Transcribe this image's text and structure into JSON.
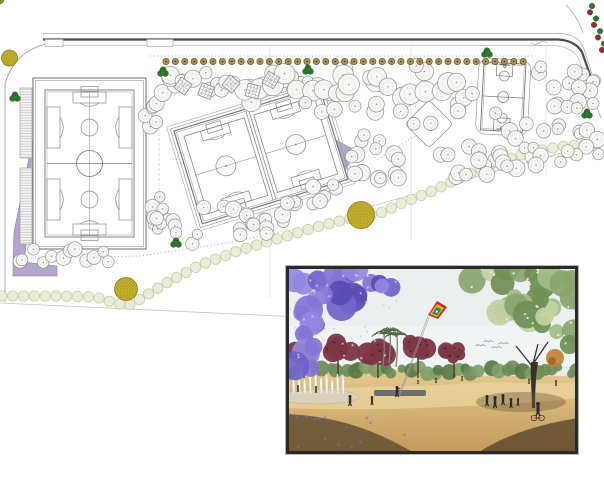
{
  "canvas": {
    "width": 604,
    "height": 480,
    "background": "#ffffff"
  },
  "palette": {
    "road_dark": "#4c4c4c",
    "road_light": "#aaaaaa",
    "sidewalk": "#c8c8c8",
    "guide": "#d9d9d9",
    "dotted": "#9a9a9a",
    "boundary": "#c4c4c4",
    "field_line": "#7a7a7a",
    "field_line_light": "#9a9a9a",
    "tree_white_fill": "#f7f7f4",
    "tree_white_stroke": "#8c8c8c",
    "tree_inner": "#b0b0b0",
    "tree_yellow": "#d2d63a",
    "tree_yellow_speck": "#8f961c",
    "tree_purple": "#8a7cc4",
    "tree_purple_speck": "#55449b",
    "tree_red": "#93312e",
    "tree_red_speck": "#5e1c1c",
    "tree_green_fleck": "#7da13c",
    "accent_green": "#2e7a2c",
    "accent_green_dark": "#1d5a1c",
    "street_tree_fill": "#b2975a",
    "street_tree_stroke": "#6b5b33",
    "street_tree_dot": "#4a3c1c",
    "scallop_fill": "#e9ecd6",
    "scallop_stroke": "#c2c9a4",
    "big_yellow_fill": "#c7b22b",
    "big_yellow_dot": "#9d8c1d",
    "big_yellow_stroke": "#8f7d16",
    "bed_purple": "#b3a5cc",
    "bed_purple_stroke": "#8f7fae",
    "pergola_stroke": "#8a8a8a",
    "photo_frame": "#2a2a2a",
    "photo_sky": "#eceff0",
    "photo_sand_top": "#e3c98e",
    "photo_sand_bottom": "#c2995a",
    "photo_sand_bright": "#ecd6a0",
    "photo_shadow": "#5d4b30",
    "photo_shadow2": "#523f27",
    "jacaranda": [
      "#6f63c8",
      "#8275d6",
      "#5a4bb2",
      "#9487e0"
    ],
    "green_tree": [
      "#8aa56e",
      "#a3bb85",
      "#c2d2a2",
      "#708f55"
    ],
    "distant_band": [
      "#6d8c58",
      "#7fa065",
      "#597947"
    ],
    "maroon_tree": "#7c3747",
    "maroon_speck": "#571f31",
    "palm_frond": "#50663c",
    "palm_trunk": "#8f8068",
    "kite_bands": [
      "#cc2b24",
      "#f2b81f",
      "#2e9c3f",
      "#1f66c4",
      "#f2f2f2"
    ],
    "string": "#9a9a9a",
    "person": "#2e2c2a",
    "water_jet": "#fdfdfd",
    "water_jet_edge": "#c8ced4",
    "basin": "#d8d2c2",
    "pool": "#3d4f63",
    "orange_tree": "#c08030",
    "bird": "#8a8a8a",
    "trunk": "#3a3228"
  },
  "plan": {
    "roads": {
      "north_top": "M43,33.5 L560,33.5 Q576,34 583,46 L597,90",
      "north_main": "M43,39.5 L558,39.5 Q575,40.5 582,52 L596,92",
      "north_inner": "M48,45.5 L554,45.5 Q570,46.5 578,57 L592,95",
      "corner_outer": "M566,5 Q578,17 583,33",
      "exit_line": "M592,95 L601,118",
      "west_arc": "M46,44 Q14,52 5,84 L5,302",
      "bays": [
        {
          "x": 45,
          "y": 39.5,
          "w": 18,
          "h": 7
        },
        {
          "x": 147,
          "y": 39.5,
          "w": 26,
          "h": 7
        }
      ],
      "wave": "M531,43 q4,3 8,0 q4,-3 8,0"
    },
    "guides": {
      "verticals": [
        {
          "x": 270,
          "y0": 46,
          "y1": 298
        },
        {
          "x": 411,
          "y0": 46,
          "y1": 240
        },
        {
          "x": 546,
          "y0": 46,
          "y1": 176
        }
      ],
      "dashed_vertical": {
        "x": 159,
        "y0": 88,
        "y1": 235
      },
      "boundary_line": "M0,303 L322,318",
      "path_edge": "M372,206 L604,141",
      "dotted_lines": [
        "M150,56 L535,56",
        "M35,258 L140,256 L220,244 L300,228 L380,210 L430,196",
        "M436,186 L570,152",
        "M402,94 L422,113",
        "M418,134 L377,160"
      ]
    },
    "scallops": {
      "polyline": [
        [
          2,
          296
        ],
        [
          60,
          296
        ],
        [
          96,
          297
        ],
        [
          112,
          302
        ],
        [
          128,
          306
        ],
        [
          142,
          298
        ],
        [
          168,
          282
        ],
        [
          200,
          265
        ],
        [
          240,
          250
        ],
        [
          280,
          238
        ],
        [
          320,
          226
        ],
        [
          352,
          218
        ],
        [
          378,
          214
        ],
        [
          400,
          204
        ],
        [
          430,
          192
        ],
        [
          462,
          177
        ],
        [
          495,
          163
        ],
        [
          530,
          152
        ],
        [
          565,
          146
        ],
        [
          602,
          143
        ]
      ],
      "spacing": 10.8,
      "radius": 5.2
    },
    "street_trees": {
      "y": 61.5,
      "x0": 166,
      "x1": 532,
      "step": 9.4,
      "radius": 3.1
    },
    "edge_trees": {
      "p0": [
        590,
        6
      ],
      "p1": [
        604,
        50
      ],
      "count": 8,
      "radius": 2.8
    },
    "big_yellow_circles": [
      [
        9.5,
        58,
        8
      ],
      [
        126,
        289,
        11.5
      ],
      [
        361,
        215,
        13.5
      ]
    ],
    "accent_trees": [
      [
        15,
        97
      ],
      [
        163,
        72
      ],
      [
        308,
        70
      ],
      [
        487,
        53
      ],
      [
        176,
        243
      ],
      [
        587,
        114
      ]
    ],
    "beds": {
      "west_wedge": "M39,108 L43,112 L24,262 L13,262 L14,232 Z",
      "corner_L": "M13,262 L24,262 L57,266 L57,276 L13,276 Z",
      "east_triangle": "M336,140 L356,151 L341,178 Z"
    },
    "left_field": {
      "outer": [
        33,
        78,
        113,
        171
      ],
      "outer2": [
        35.5,
        80.5,
        108,
        166
      ],
      "inner": [
        45,
        90,
        89,
        147
      ],
      "inner2": [
        47,
        92,
        85,
        143
      ],
      "mid_y": 163.5,
      "center": [
        89.5,
        163.5,
        13
      ],
      "sub_circles": [
        [
          89.5,
          127.5,
          8.5
        ],
        [
          89.5,
          199.5,
          8.5
        ]
      ],
      "bleachers": [
        [
          20,
          88,
          12,
          70
        ],
        [
          20,
          168,
          12,
          76
        ]
      ],
      "small_buildings": [
        [
          60,
          87,
          13,
          9
        ],
        [
          60,
          98,
          13,
          16
        ]
      ]
    },
    "rotated_block": {
      "x": 174,
      "y": 131,
      "angle": -17,
      "w": 152,
      "h": 97,
      "pitch_xs": [
        8,
        81
      ],
      "pitch_w": 63
    },
    "basketball": {
      "x": 484,
      "y": 62,
      "angle": 3,
      "w": 42,
      "h": 68
    },
    "diamond": {
      "cx": 429,
      "cy": 124,
      "half": 17
    },
    "pergolas": [
      [
        183,
        86,
        35
      ],
      [
        206,
        91,
        20
      ],
      [
        231,
        84,
        40
      ],
      [
        253,
        91,
        15
      ],
      [
        271,
        80,
        30
      ]
    ],
    "clusters": [
      {
        "name": "yellow-grove-west",
        "type": "yellow",
        "pts": [
          [
            150,
            126
          ],
          [
            153,
            104
          ],
          [
            162,
            90
          ],
          [
            176,
            82
          ],
          [
            192,
            88
          ],
          [
            207,
            80
          ]
        ],
        "count": 15,
        "jitter": 9,
        "rmin": 5.5,
        "rmax": 9,
        "seed": 11
      },
      {
        "name": "yellow-grove-north",
        "type": "yellow",
        "pts": [
          [
            215,
            88
          ],
          [
            235,
            78
          ],
          [
            255,
            90
          ],
          [
            277,
            79
          ],
          [
            298,
            90
          ],
          [
            318,
            82
          ],
          [
            332,
            94
          ]
        ],
        "count": 15,
        "jitter": 8,
        "rmin": 5.5,
        "rmax": 9,
        "mix": 0.35,
        "seed": 22
      },
      {
        "name": "white-grove-north",
        "type": "white",
        "pts": [
          [
            250,
            96
          ],
          [
            285,
            74
          ],
          [
            320,
            92
          ],
          [
            355,
            72
          ],
          [
            390,
            94
          ],
          [
            425,
            76
          ],
          [
            455,
            95
          ],
          [
            472,
            84
          ]
        ],
        "count": 30,
        "jitter": 13,
        "rmin": 7,
        "rmax": 11,
        "seed": 33
      },
      {
        "name": "white-grove-tail",
        "type": "white",
        "pts": [
          [
            300,
            108
          ],
          [
            340,
            112
          ],
          [
            380,
            104
          ],
          [
            420,
            118
          ],
          [
            450,
            112
          ]
        ],
        "count": 10,
        "jitter": 8,
        "rmin": 6,
        "rmax": 9,
        "seed": 44
      },
      {
        "name": "purple-grove-ne",
        "type": "purple",
        "pts": [
          [
            540,
            66
          ],
          [
            562,
            84
          ],
          [
            584,
            68
          ],
          [
            600,
            86
          ],
          [
            580,
            100
          ],
          [
            556,
            108
          ],
          [
            588,
            112
          ]
        ],
        "count": 16,
        "jitter": 9,
        "rmin": 5.5,
        "rmax": 8.5,
        "mix": 0.3,
        "seed": 55
      },
      {
        "name": "purple-grove-east",
        "type": "purple",
        "pts": [
          [
            502,
            122
          ],
          [
            524,
            136
          ],
          [
            548,
            124
          ],
          [
            572,
            140
          ],
          [
            594,
            128
          ],
          [
            600,
            152
          ],
          [
            566,
            158
          ],
          [
            534,
            150
          ]
        ],
        "count": 18,
        "jitter": 9,
        "rmin": 5.5,
        "rmax": 8.5,
        "mix": 0.25,
        "seed": 66
      },
      {
        "name": "purple-grove-south",
        "type": "purple",
        "pts": [
          [
            442,
            162
          ],
          [
            468,
            150
          ],
          [
            494,
            160
          ],
          [
            520,
            148
          ],
          [
            546,
            156
          ],
          [
            452,
            172
          ],
          [
            482,
            170
          ],
          [
            512,
            166
          ]
        ],
        "count": 20,
        "jitter": 8,
        "rmin": 5.5,
        "rmax": 8.5,
        "mix": 0.3,
        "seed": 77
      },
      {
        "name": "red-grove-center",
        "type": "red",
        "pts": [
          [
            356,
            138
          ],
          [
            376,
            150
          ],
          [
            392,
            164
          ],
          [
            402,
            180
          ],
          [
            384,
            186
          ],
          [
            362,
            172
          ],
          [
            352,
            154
          ]
        ],
        "count": 15,
        "jitter": 8,
        "rmin": 5.5,
        "rmax": 8.5,
        "mix": 0.3,
        "seed": 88
      },
      {
        "name": "red-grove-south",
        "type": "red",
        "pts": [
          [
            208,
            202
          ],
          [
            232,
            212
          ],
          [
            256,
            222
          ],
          [
            278,
            214
          ],
          [
            300,
            204
          ],
          [
            322,
            192
          ],
          [
            336,
            184
          ],
          [
            240,
            230
          ],
          [
            266,
            228
          ]
        ],
        "count": 24,
        "jitter": 9,
        "rmin": 5.5,
        "rmax": 8.5,
        "mix": 0.35,
        "seed": 99
      },
      {
        "name": "red-grove-west",
        "type": "red",
        "pts": [
          [
            152,
            192
          ],
          [
            162,
            208
          ],
          [
            172,
            224
          ],
          [
            158,
            232
          ],
          [
            148,
            214
          ],
          [
            182,
            238
          ],
          [
            198,
            236
          ]
        ],
        "count": 14,
        "jitter": 8,
        "rmin": 5,
        "rmax": 8,
        "mix": 0.35,
        "seed": 111
      },
      {
        "name": "white-green-row-south",
        "type": "white-green",
        "pts": [
          [
            18,
            262
          ],
          [
            34,
            254
          ],
          [
            50,
            261
          ],
          [
            66,
            250
          ],
          [
            82,
            257
          ],
          [
            96,
            251
          ],
          [
            106,
            260
          ]
        ],
        "count": 12,
        "jitter": 5,
        "rmin": 5.5,
        "rmax": 7.5,
        "seed": 122
      }
    ]
  },
  "photo": {
    "frame": {
      "x": 286,
      "y": 266,
      "w": 292,
      "h": 188
    },
    "horizon_y": 104,
    "jacaranda_pts": [
      [
        8,
        12
      ],
      [
        30,
        8
      ],
      [
        55,
        15
      ],
      [
        80,
        10
      ],
      [
        102,
        20
      ],
      [
        70,
        35
      ],
      [
        40,
        30
      ],
      [
        15,
        45
      ],
      [
        35,
        55
      ],
      [
        10,
        70
      ],
      [
        25,
        85
      ],
      [
        8,
        100
      ]
    ],
    "green_tree_pts": [
      [
        195,
        15
      ],
      [
        220,
        8
      ],
      [
        245,
        14
      ],
      [
        270,
        10
      ],
      [
        288,
        18
      ],
      [
        282,
        40
      ],
      [
        260,
        35
      ],
      [
        235,
        30
      ],
      [
        210,
        38
      ],
      [
        250,
        55
      ],
      [
        275,
        60
      ],
      [
        290,
        75
      ]
    ],
    "maroon_trees": [
      [
        18,
        88,
        13
      ],
      [
        52,
        80,
        16
      ],
      [
        92,
        84,
        15
      ],
      [
        132,
        82,
        14
      ],
      [
        168,
        86,
        12
      ]
    ],
    "palms": [
      [
        97,
        100
      ],
      [
        103,
        97
      ],
      [
        110,
        101
      ]
    ],
    "wall": {
      "x": 160,
      "y": 101,
      "w": 132,
      "h": 9
    },
    "pool": {
      "x": 88,
      "y": 124,
      "w": 52,
      "h": 6
    },
    "trunk": "M245,96 C244,110 246,125 246,142 L249,142 C249,124 250,108 252,96 Z",
    "orange_tree": [
      269,
      92,
      9
    ],
    "kite": {
      "bands": [
        "M142,49 L151,35 L161,41 L152,53 Z",
        "M144,48 L151,38 L158,42 L151,51 Z",
        "M146,47.5 L151,40.5 L155.5,43.5 L151,49.5 Z",
        "M147.5,47 L151,42.5 L153.5,44.5 L151,48 Z",
        "M149,46.5 L151,44 L152.2,45.2 L151,47 Z"
      ],
      "strings": [
        "M142,50 L113,129",
        "M143,51.5 L114,129"
      ]
    },
    "fountain": {
      "basin": [
        32,
        131,
        42,
        7
      ],
      "jet_x0": 2,
      "jet_x1": 62,
      "jet_step": 5.5,
      "base_y": 128
    },
    "people": [
      {
        "x": 64,
        "y": 140,
        "h": 11
      },
      {
        "x": 86,
        "y": 139,
        "h": 9
      },
      {
        "x": 111,
        "y": 131,
        "h": 11,
        "kind": "kite-holder"
      },
      {
        "x": 30,
        "y": 127,
        "h": 7
      },
      {
        "x": 12,
        "y": 126,
        "h": 7
      },
      {
        "x": 201,
        "y": 140,
        "h": 11
      },
      {
        "x": 209,
        "y": 142,
        "h": 12
      },
      {
        "x": 217,
        "y": 139,
        "h": 11
      },
      {
        "x": 225,
        "y": 142,
        "h": 10
      },
      {
        "x": 232,
        "y": 140,
        "h": 8
      },
      {
        "x": 252,
        "y": 150,
        "h": 14,
        "kind": "cyclist"
      },
      {
        "x": 150,
        "y": 117,
        "h": 5
      },
      {
        "x": 176,
        "y": 115,
        "h": 5
      },
      {
        "x": 132,
        "y": 118,
        "h": 4
      },
      {
        "x": 243,
        "y": 118,
        "h": 5
      },
      {
        "x": 270,
        "y": 120,
        "h": 6
      }
    ],
    "birds": [
      [
        192,
        80
      ],
      [
        200,
        76
      ],
      [
        208,
        82
      ],
      [
        215,
        78
      ]
    ],
    "shadow_left": "M0,148 C40,150 80,158 130,188 L0,188 Z",
    "shadow_right": "M190,188 C220,168 255,158 292,152 L292,188 Z",
    "sand_bright": "M0,128 C60,118 120,122 170,118 C220,114 260,120 292,116 L292,132 C220,140 80,146 0,142 Z"
  }
}
